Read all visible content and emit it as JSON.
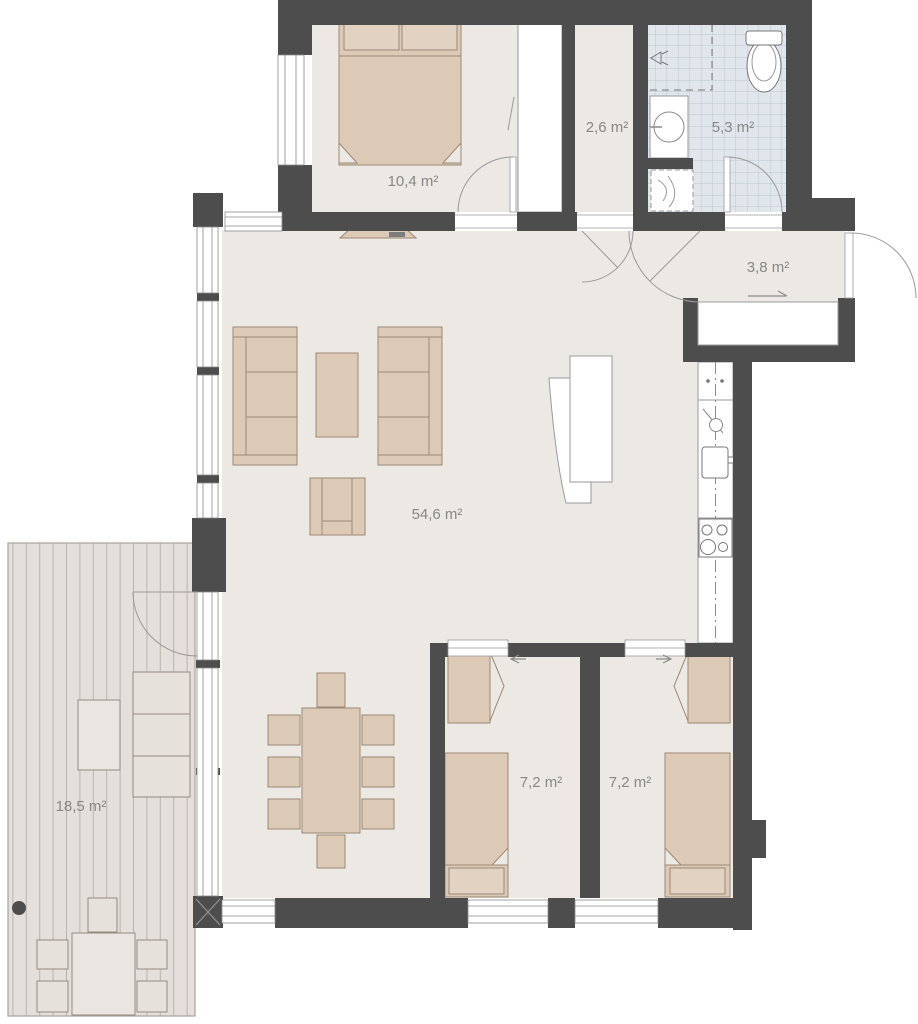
{
  "plan": {
    "rooms": {
      "main_bedroom": {
        "area_label": "10,4 m²"
      },
      "hall": {
        "area_label": "2,6 m²"
      },
      "bathroom": {
        "area_label": "5,3 m²"
      },
      "entry": {
        "area_label": "3,8 m²"
      },
      "living_kitchen": {
        "area_label": "54,6 m²"
      },
      "bedroom_left": {
        "area_label": "7,2 m²"
      },
      "bedroom_right": {
        "area_label": "7,2 m²"
      },
      "terrace": {
        "area_label": "18,5 m²"
      }
    },
    "colors": {
      "wall": "#4d4d4d",
      "floor": "#ece8e4",
      "furniture": "#dccab7",
      "furniture_light": "#e7e1dc",
      "tile": "#e0e6ec",
      "tile_grid": "#bcc7d1",
      "deck": "#e4dfdb",
      "deck_stripe": "#b9b3ae",
      "label_text": "#878787",
      "thin_line": "#999999"
    }
  }
}
